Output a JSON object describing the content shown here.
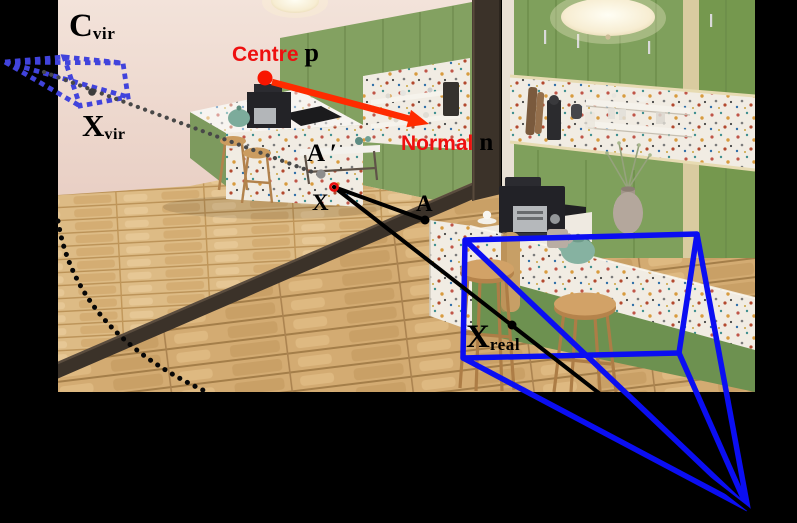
{
  "figure": {
    "width": 797,
    "height": 523,
    "background": "#000000",
    "description": "Mirror-reflection camera geometry diagram drawn over a rendered kitchen scene"
  },
  "photo": {
    "x": 58,
    "y": 0,
    "width": 697,
    "height": 392
  },
  "palette": {
    "frustum_blue": "#0b0ef2",
    "virtual_frustum_blue": "#4143dc",
    "annotation_red": "#ee1010",
    "arrow_red": "#ff2b00",
    "cabinet_green": "#7fa05c",
    "wood_floor": "#d6b27a",
    "mirror_frame_brown": "#3b3229",
    "wall_pink": "#edd8cd",
    "terrazzo_white": "#f1ece3"
  },
  "labels": {
    "c_vir": {
      "main": "C",
      "sub": "vir",
      "x": 69,
      "y": 10
    },
    "x_vir": {
      "main": "X",
      "sub": "vir",
      "x": 82,
      "y": 110
    },
    "centre": {
      "word": "Centre",
      "symbol": "p",
      "x": 232,
      "y": 40
    },
    "normal": {
      "word": "Normal",
      "symbol": "n",
      "x": 401,
      "y": 130
    },
    "a_prime": {
      "text": "A ′",
      "x": 307,
      "y": 141
    },
    "x_point": {
      "text": "X",
      "x": 312,
      "y": 191
    },
    "a_point": {
      "text": "A",
      "x": 416,
      "y": 192
    },
    "x_real": {
      "main": "X",
      "sub": "real",
      "x": 466,
      "y": 321
    }
  },
  "annotations": {
    "colors": {
      "real_frustum": "#0b0ef2",
      "virtual_frustum": "#4143dc",
      "virtual_ray": "#484848",
      "floor_curve": "#070707",
      "black_ray": "#000000",
      "arrow": "#ff2b00"
    },
    "real_frustum": {
      "apex": [
        748,
        509
      ],
      "plane": [
        [
          465,
          240
        ],
        [
          697,
          234
        ],
        [
          679,
          353
        ],
        [
          463,
          358
        ]
      ]
    },
    "virtual_frustum": {
      "apex": [
        5,
        62
      ],
      "plane": [
        [
          64,
          57
        ],
        [
          123,
          63
        ],
        [
          128,
          97
        ],
        [
          80,
          106
        ]
      ]
    },
    "virtual_ray": {
      "from": [
        44,
        72
      ],
      "to": [
        323,
        176
      ]
    },
    "rays": [
      {
        "from": [
          334,
          187
        ],
        "to": [
          425,
          220
        ]
      },
      {
        "from": [
          334,
          187
        ],
        "to": [
          748,
          509
        ]
      }
    ],
    "floor_curve": {
      "start": [
        58,
        221
      ],
      "ctrl": [
        76,
        332
      ],
      "end": [
        207,
        392
      ]
    },
    "arrow": {
      "from": [
        272,
        82
      ],
      "to": [
        429,
        124
      ]
    },
    "points": [
      {
        "name": "centre-p-dot",
        "x": 265,
        "y": 78,
        "r": 7.5,
        "fill": "#f81500"
      },
      {
        "name": "principal-point-dot",
        "x": 92,
        "y": 92,
        "r": 3.8,
        "fill": "#3c3c3c"
      },
      {
        "name": "a-prime-dot",
        "x": 321,
        "y": 174,
        "r": 4.6,
        "fill": "#8d8d8d"
      },
      {
        "name": "x-mirror-ring",
        "x": 334,
        "y": 187,
        "r": 3.6,
        "fill": "none",
        "stroke": "#e80c0c",
        "stroke_width": 2.6
      },
      {
        "name": "a-dot",
        "x": 425,
        "y": 220,
        "r": 4.5,
        "fill": "#000000"
      },
      {
        "name": "x-real-dot",
        "x": 512,
        "y": 325,
        "r": 4.5,
        "fill": "#000000"
      }
    ]
  }
}
